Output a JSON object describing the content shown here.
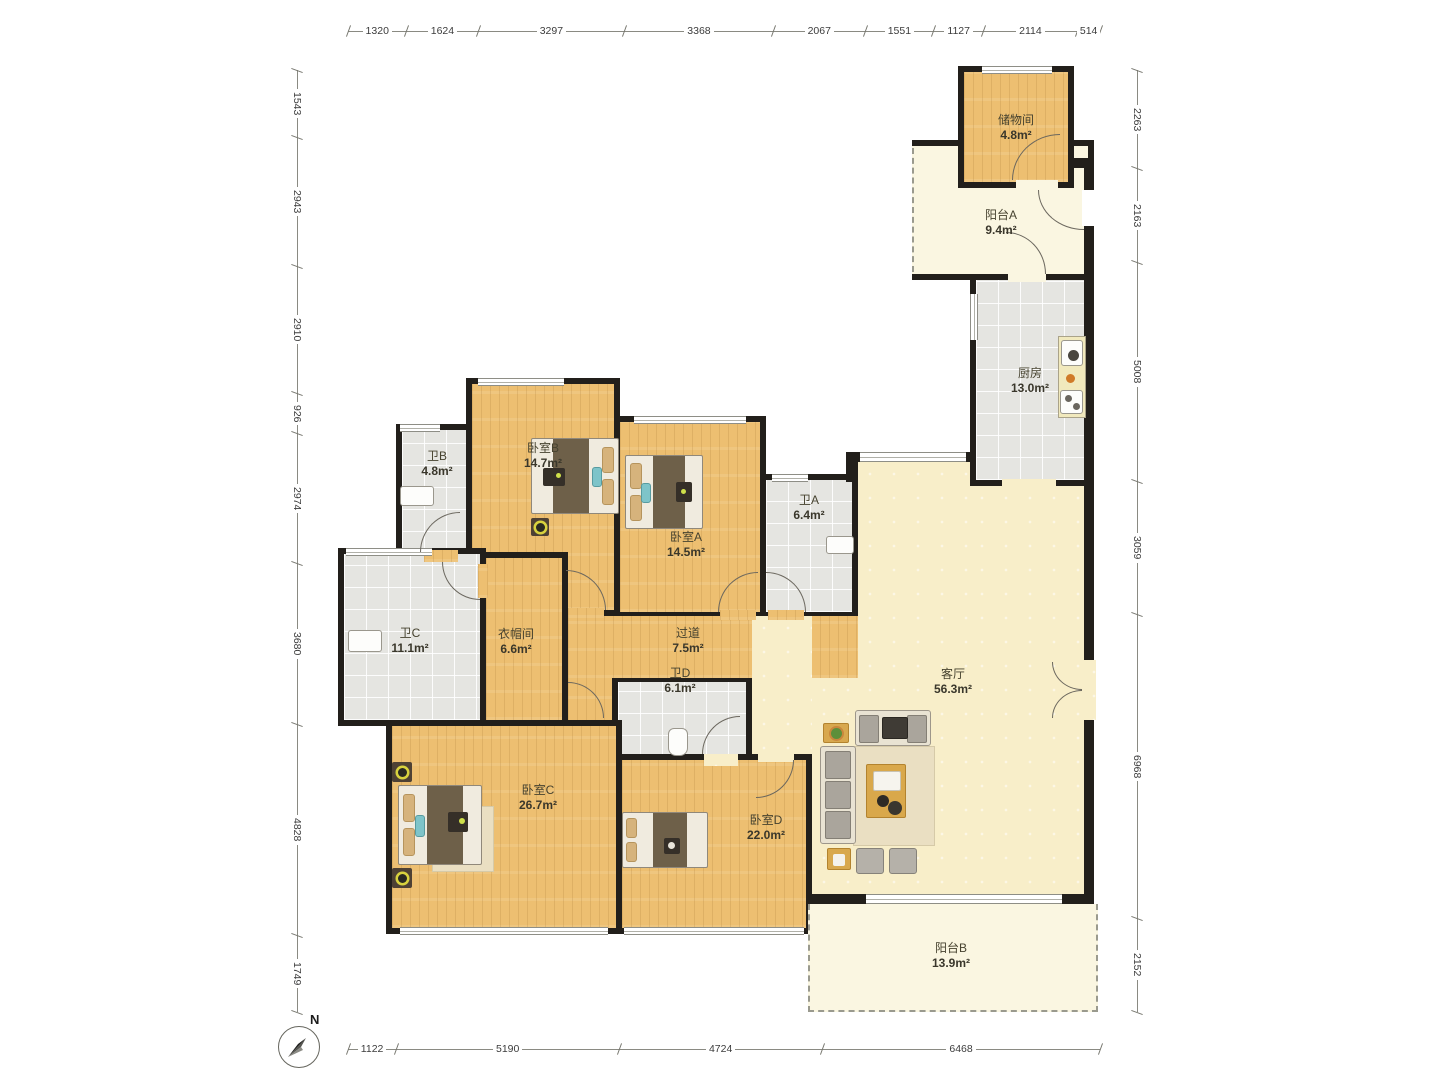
{
  "compass": {
    "north_label": "N"
  },
  "rulers": {
    "top": {
      "values": [
        "1320",
        "1624",
        "3297",
        "3368",
        "2067",
        "1551",
        "1127",
        "2114",
        "514"
      ]
    },
    "bottom": {
      "values": [
        "1122",
        "5190",
        "4724",
        "6468"
      ]
    },
    "left": {
      "values": [
        "1543",
        "2943",
        "2910",
        "926",
        "2974",
        "3680",
        "4828",
        "1749"
      ]
    },
    "right": {
      "values": [
        "2263",
        "2163",
        "5008",
        "3059",
        "6968",
        "2152"
      ]
    }
  },
  "rooms": {
    "storage": {
      "name": "储物间",
      "area": "4.8m²"
    },
    "balcony_a": {
      "name": "阳台A",
      "area": "9.4m²"
    },
    "kitchen": {
      "name": "厨房",
      "area": "13.0m²"
    },
    "bath_b": {
      "name": "卫B",
      "area": "4.8m²"
    },
    "bedroom_b": {
      "name": "卧室B",
      "area": "14.7m²"
    },
    "bedroom_a": {
      "name": "卧室A",
      "area": "14.5m²"
    },
    "bath_a": {
      "name": "卫A",
      "area": "6.4m²"
    },
    "bath_c": {
      "name": "卫C",
      "area": "11.1m²"
    },
    "cloakroom": {
      "name": "衣帽间",
      "area": "6.6m²"
    },
    "hallway": {
      "name": "过道",
      "area": "7.5m²"
    },
    "living": {
      "name": "客厅",
      "area": "56.3m²"
    },
    "bath_d": {
      "name": "卫D",
      "area": "6.1m²"
    },
    "bedroom_c": {
      "name": "卧室C",
      "area": "26.7m²"
    },
    "bedroom_d": {
      "name": "卧室D",
      "area": "22.0m²"
    },
    "balcony_b": {
      "name": "阳台B",
      "area": "13.9m²"
    }
  },
  "colors": {
    "wall": "#221f1b",
    "wood": "#edbf71",
    "tile": "#e5e5e1",
    "living": "#f8eec9",
    "balcony": "#faf6e1",
    "lamp": "#d8d23e"
  }
}
